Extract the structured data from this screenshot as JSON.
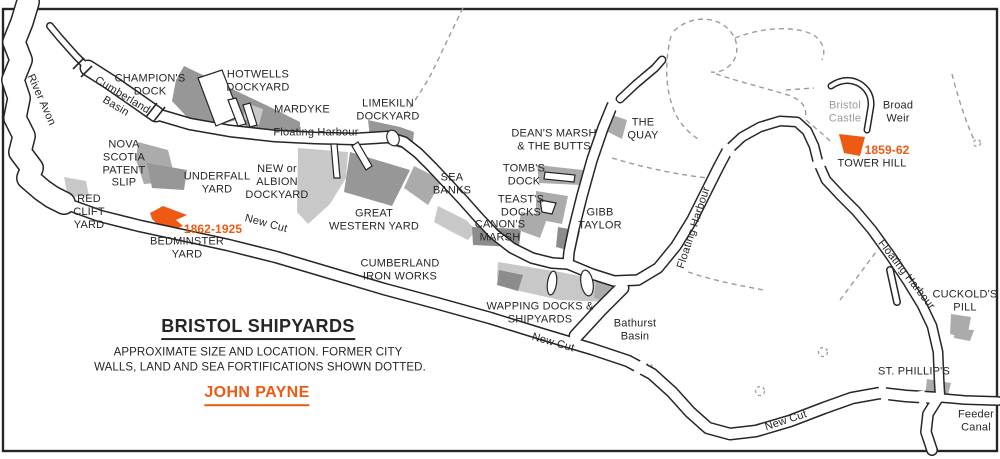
{
  "colors": {
    "accent_orange": "#ef5a13",
    "yard_dark": "#979797",
    "yard_mid": "#ababab",
    "yard_light": "#c8c8c8",
    "marsh_dark": "#8c8c8c",
    "dashed_gray": "#9b9b9b",
    "castle_text_gray": "#9a9a9a"
  },
  "title_block": {
    "title": "BRISTOL SHIPYARDS",
    "caption_line1": "APPROXIMATE SIZE AND LOCATION. FORMER CITY",
    "caption_line2": "WALLS, LAND AND SEA FORTIFICATIONS SHOWN DOTTED.",
    "author": "JOHN PAYNE"
  },
  "labels": {
    "river_avon": [
      "River Avon"
    ],
    "cumberland_basin": [
      "Cumberland",
      "Basin"
    ],
    "champions_dock": [
      "CHAMPION'S",
      "DOCK"
    ],
    "hotwells_dockyard": [
      "HOTWELLS",
      "DOCKYARD"
    ],
    "mardyke": [
      "MARDYKE"
    ],
    "floating_harbour_west": [
      "Floating Harbour"
    ],
    "limekiln_dockyard": [
      "LIMEKILN",
      "DOCKYARD"
    ],
    "nova_scotia": [
      "NOVA",
      "SCOTIA",
      "PATENT",
      "SLIP"
    ],
    "underfall_yard": [
      "UNDERFALL",
      "YARD"
    ],
    "new_albion_dockyard": [
      "NEW or",
      "ALBION",
      "DOCKYARD"
    ],
    "red_clift_yard": [
      "RED",
      "CLIFT",
      "YARD"
    ],
    "bedminster_dates": [
      "1862-1925"
    ],
    "bedminster_yard": [
      "BEDMINSTER",
      "YARD"
    ],
    "new_cut_west": [
      "New Cut"
    ],
    "great_western_yard": [
      "GREAT",
      "WESTERN YARD"
    ],
    "sea_banks": [
      "SEA",
      "BANKS"
    ],
    "cumberland_iron_works": [
      "CUMBERLAND",
      "IRON WORKS"
    ],
    "deans_marsh": [
      "DEAN'S MARSH",
      "& THE BUTTS"
    ],
    "tombs_dock": [
      "TOMB'S",
      "DOCK"
    ],
    "teasts_docks": [
      "TEAST'S",
      "DOCKS"
    ],
    "canons_marsh": [
      "CANON'S",
      "MARSH"
    ],
    "gibb_taylor": [
      "GIBB",
      "TAYLOR"
    ],
    "the_quay": [
      "THE",
      "QUAY"
    ],
    "floating_harbour_centre": [
      "Floating Harbour"
    ],
    "wapping_docks": [
      "WAPPING DOCKS &",
      "SHIPYARDS"
    ],
    "bathurst_basin": [
      "Bathurst",
      "Basin"
    ],
    "new_cut_centre": [
      "New Cut"
    ],
    "bristol_castle": [
      "Bristol",
      "Castle"
    ],
    "broad_weir": [
      "Broad",
      "Weir"
    ],
    "tower_hill_dates": [
      "1859-62"
    ],
    "tower_hill": [
      "TOWER HILL"
    ],
    "floating_harbour_east": [
      "Floating Harbour"
    ],
    "cuckolds_pill": [
      "CUCKOLD'S",
      "PILL"
    ],
    "st_phillips": [
      "ST. PHILLIP'S"
    ],
    "feeder_canal": [
      "Feeder",
      "Canal"
    ],
    "new_cut_east": [
      "New Cut"
    ]
  }
}
